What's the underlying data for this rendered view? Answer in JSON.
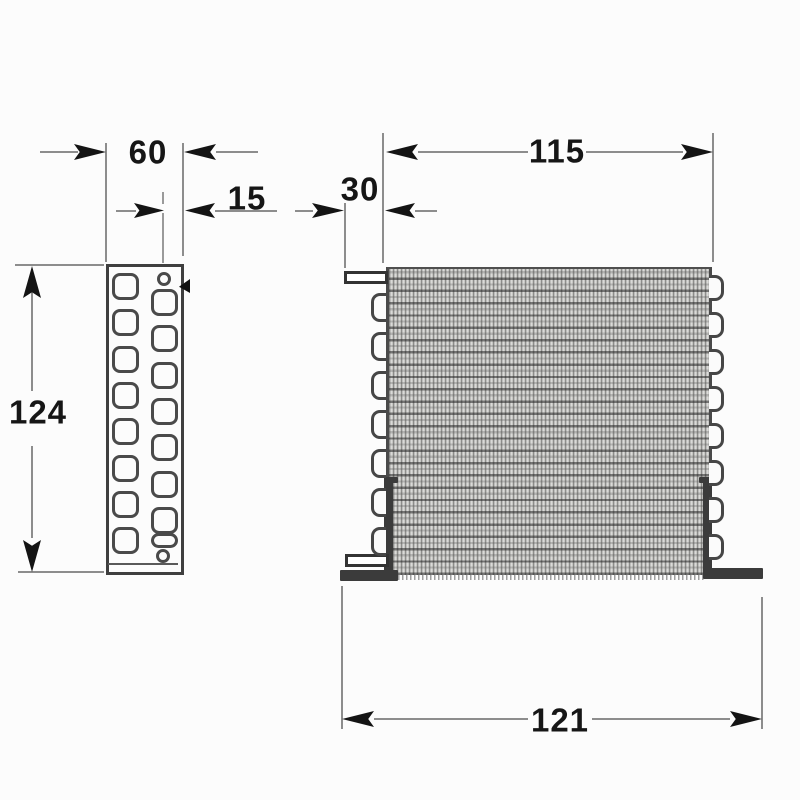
{
  "title": "Condenser coil technical drawing, side view and front view",
  "colors": {
    "background": "#fcfcfc",
    "dimension_line": "#8d8d8d",
    "ink": "#161616",
    "part_outline": "#3f3f3f",
    "fin_tone": "#dededa"
  },
  "dimensions": {
    "plate_width": {
      "value": "60",
      "meaning": "side plate width"
    },
    "hole_offset": {
      "value": "15",
      "meaning": "hole column to plate edge offset"
    },
    "fin_width": {
      "value": "115",
      "meaning": "fin pack width"
    },
    "pipe_stub": {
      "value": "30",
      "meaning": "inlet pipe stub length"
    },
    "plate_height": {
      "value": "124",
      "meaning": "overall height"
    },
    "overall_width": {
      "value": "121",
      "meaning": "overall width across feet"
    }
  },
  "side_view": {
    "left_hole_count": 8,
    "right_hole_count": 8,
    "pilot_hole_count": 2
  },
  "front_view": {
    "left_return_bend_count": 7,
    "right_return_bend_count": 8,
    "tube_row_pitch_px": 12.3,
    "fin_pitch_px": 4
  },
  "geometry": {
    "left_hole_tops": [
      273,
      309,
      346,
      382,
      418,
      455,
      491,
      527
    ],
    "right_holes": [
      {
        "top": 289,
        "h": 21
      },
      {
        "top": 325,
        "h": 21
      },
      {
        "top": 362,
        "h": 21
      },
      {
        "top": 398,
        "h": 21
      },
      {
        "top": 434,
        "h": 21
      },
      {
        "top": 471,
        "h": 21
      },
      {
        "top": 507,
        "h": 21
      },
      {
        "top": 533,
        "h": 9
      }
    ],
    "pilot_holes": [
      {
        "left": 157,
        "top": 272
      },
      {
        "left": 156,
        "top": 549
      }
    ],
    "left_bend_tops": [
      293,
      332,
      371,
      410,
      449,
      488,
      527
    ],
    "right_bend_tops": [
      275,
      312,
      349,
      386,
      423,
      460,
      497,
      534
    ]
  }
}
